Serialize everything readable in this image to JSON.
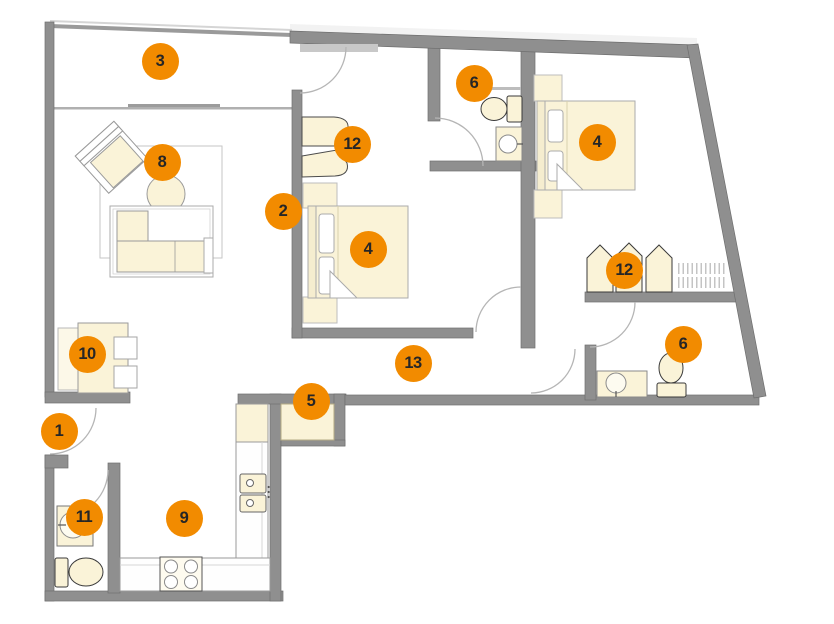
{
  "theme": {
    "background": "#ffffff",
    "badge_color": "#F28B00",
    "badge_text_color": "#262626",
    "wall_color": "#8F8F8F",
    "wall_edge_color": "#6E6E6E",
    "furniture_fill": "#FAF3D8",
    "furniture_fill_light": "#FCF8E8",
    "furniture_stroke": "#9A9A9A",
    "fixture_stroke": "#3A3A3A",
    "door_arc_color": "#B5B5B5"
  },
  "markers": [
    {
      "label": "1",
      "x": 59,
      "y": 431
    },
    {
      "label": "2",
      "x": 283,
      "y": 211
    },
    {
      "label": "3",
      "x": 160,
      "y": 61
    },
    {
      "label": "4",
      "x": 368,
      "y": 249
    },
    {
      "label": "4",
      "x": 597,
      "y": 142
    },
    {
      "label": "5",
      "x": 311,
      "y": 401
    },
    {
      "label": "6",
      "x": 474,
      "y": 83
    },
    {
      "label": "6",
      "x": 683,
      "y": 344
    },
    {
      "label": "8",
      "x": 162,
      "y": 162
    },
    {
      "label": "9",
      "x": 184,
      "y": 518
    },
    {
      "label": "10",
      "x": 87,
      "y": 354
    },
    {
      "label": "11",
      "x": 84,
      "y": 517
    },
    {
      "label": "12",
      "x": 352,
      "y": 144
    },
    {
      "label": "12",
      "x": 624,
      "y": 270
    },
    {
      "label": "13",
      "x": 413,
      "y": 363
    }
  ]
}
